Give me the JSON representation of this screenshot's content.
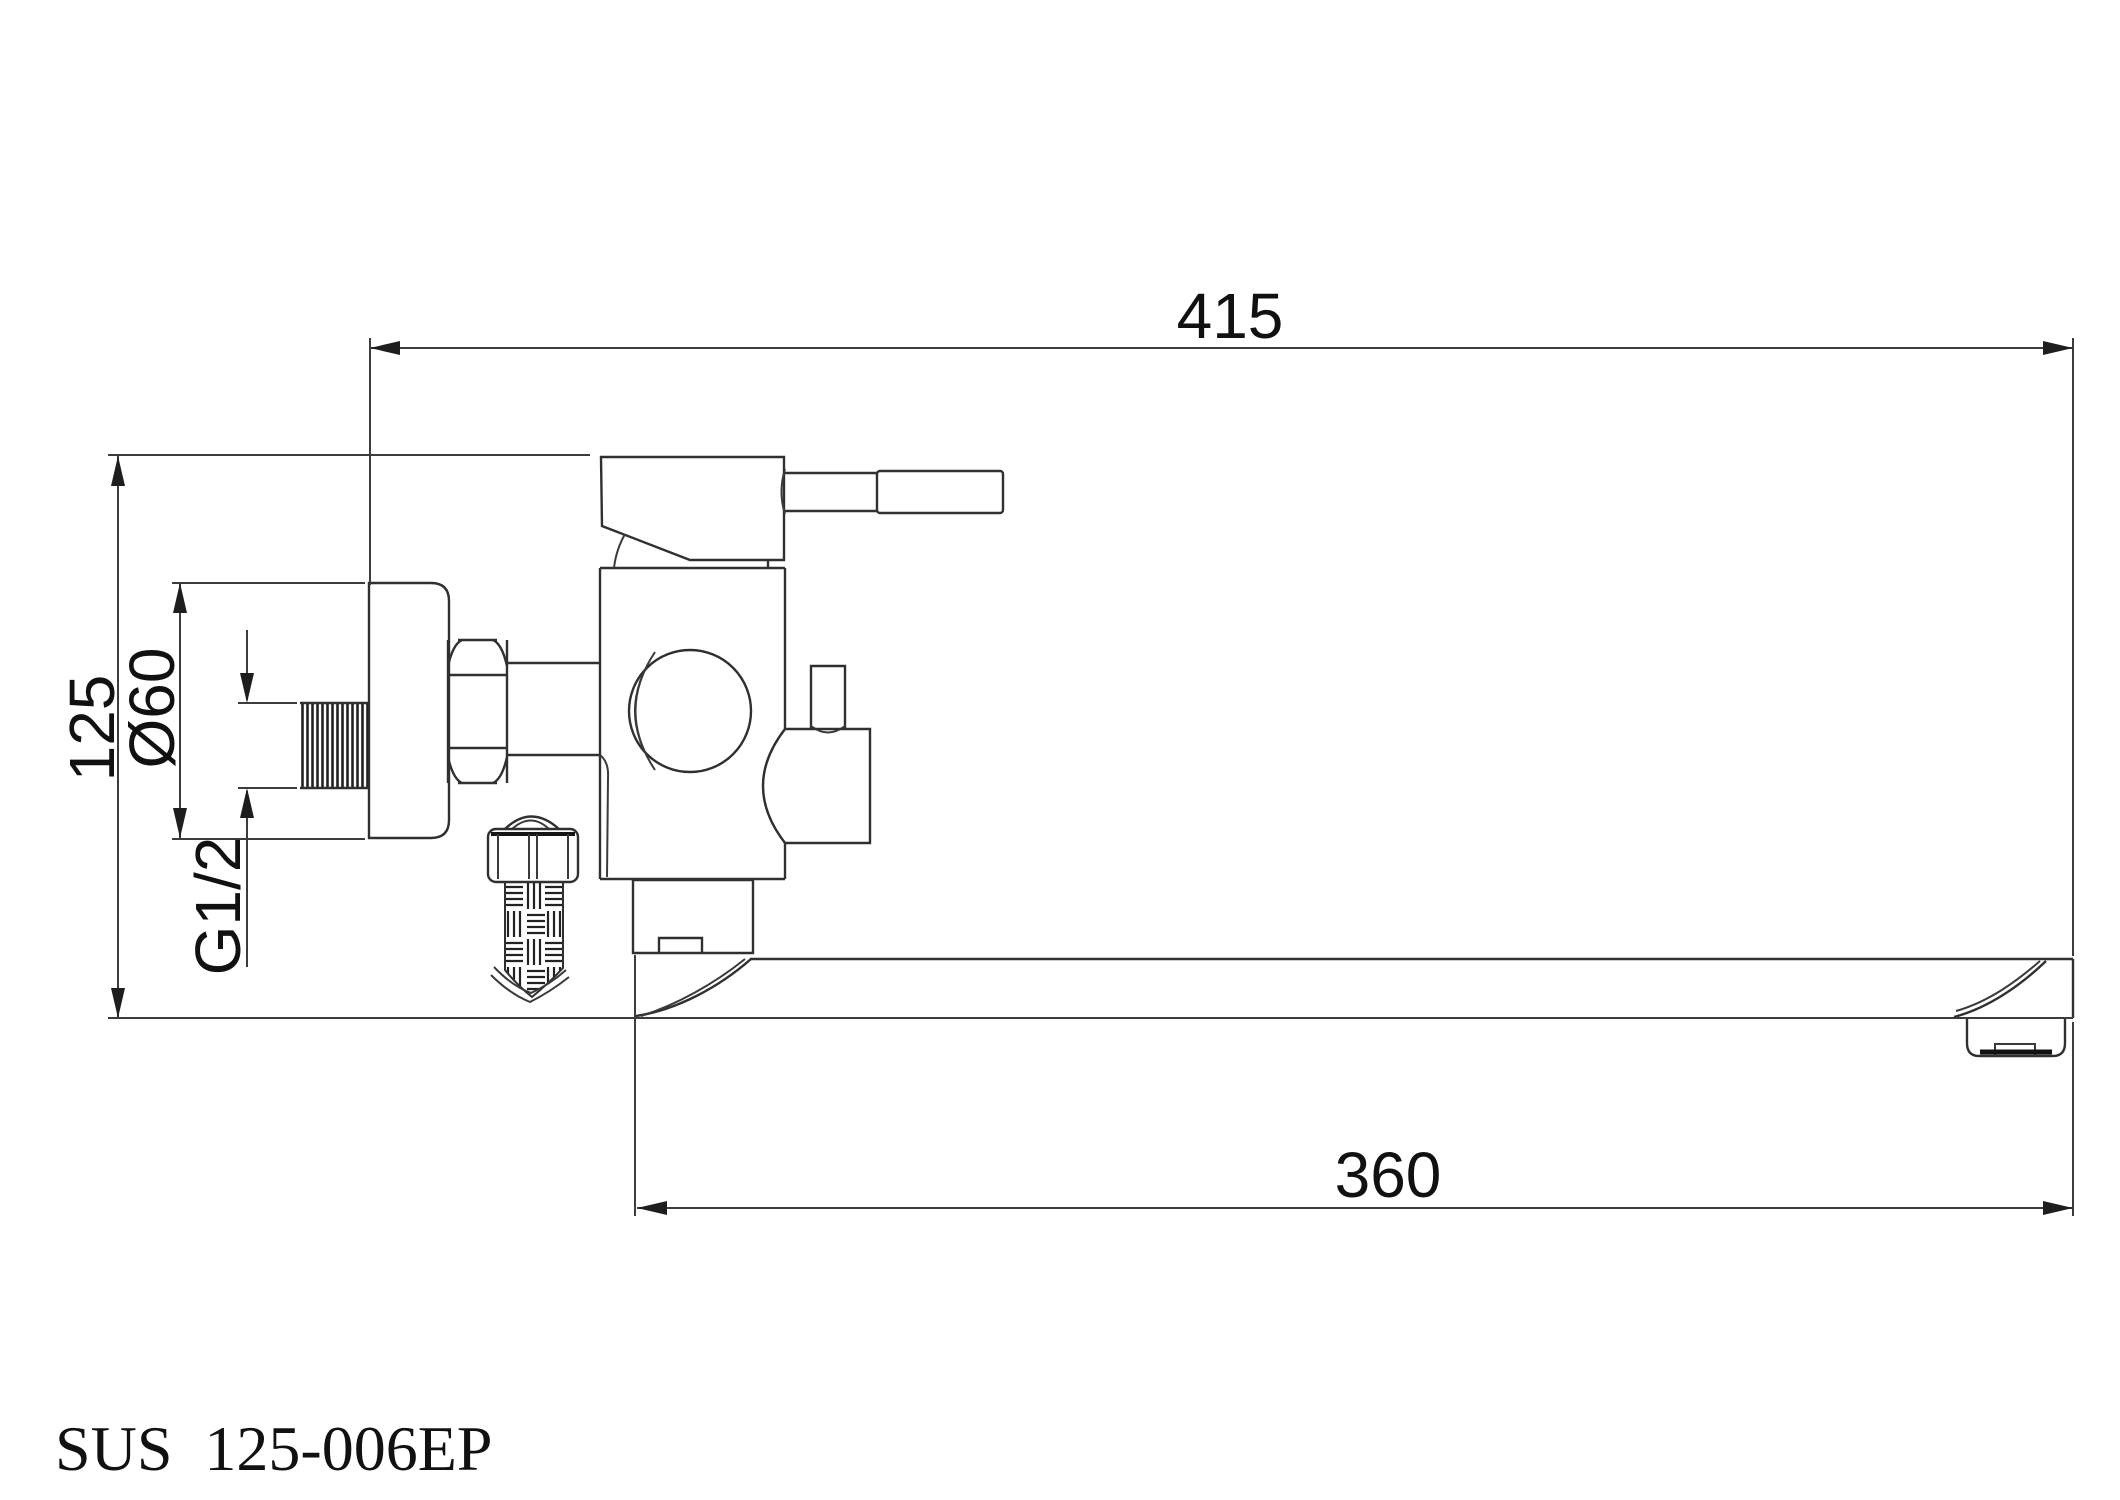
{
  "drawing": {
    "background": "#ffffff",
    "line_color": "#303030",
    "text_color": "#111111"
  },
  "title_block": {
    "part_number": "SUS 125-006EP"
  },
  "dimensions": {
    "overall_length": "415",
    "spout_reach": "360",
    "overall_height": "125",
    "flange_diameter": "Ø60",
    "thread_size": "G1/2"
  }
}
